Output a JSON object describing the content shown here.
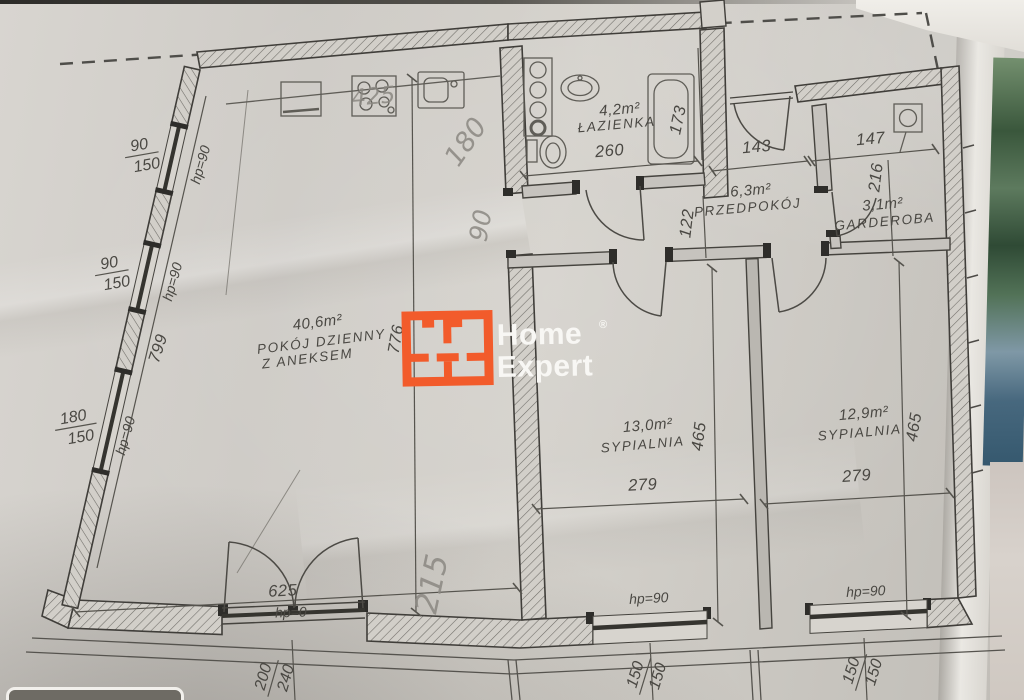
{
  "plan": {
    "rooms": {
      "living": {
        "area": "40,6m²",
        "name_line1": "POKÓJ DZIENNY",
        "name_line2": "Z ANEKSEM"
      },
      "bathroom": {
        "area": "4,2m²",
        "name": "ŁAZIENKA"
      },
      "hallway": {
        "area": "6,3m²",
        "name": "PRZEDPOKÓJ"
      },
      "wardrobe": {
        "area": "3,1m²",
        "name": "GARDEROBA"
      },
      "bedroom1": {
        "area": "13,0m²",
        "name": "SYPIALNIA"
      },
      "bedroom2": {
        "area": "12,9m²",
        "name": "SYPIALNIA"
      }
    },
    "dimensions": {
      "bathroom_width": "260",
      "bathroom_depth": "173",
      "hall_width": "143",
      "wardrobe_width": "147",
      "wardrobe_depth": "216",
      "corridor_depth": "122",
      "living_depth": "776",
      "left_wall": "799",
      "living_width": "625",
      "bedroom1_depth": "465",
      "bedroom1_width": "279",
      "bedroom2_depth": "465",
      "bedroom2_width": "279"
    },
    "windows": {
      "left1": {
        "w": "90",
        "h": "150",
        "sill": "hp=90"
      },
      "left2": {
        "w": "90",
        "h": "150",
        "sill": "hp=90"
      },
      "left3": {
        "w": "180",
        "h": "150",
        "sill": "hp=90"
      },
      "balcony_door": {
        "w": "200",
        "h": "240",
        "sill": "hp=0"
      },
      "bottom1": {
        "w": "150",
        "h": "150",
        "sill": "hp=90"
      },
      "bottom2": {
        "w": "150",
        "h": "150",
        "sill": "hp=90"
      }
    },
    "handwritten": {
      "kitchen_width": "425",
      "note_180": "180",
      "note_90": "90",
      "note_215": "215"
    }
  },
  "logo": {
    "word1": "Home",
    "word2": "Expert",
    "registered": "®",
    "accent_color": "#f25b2b"
  }
}
